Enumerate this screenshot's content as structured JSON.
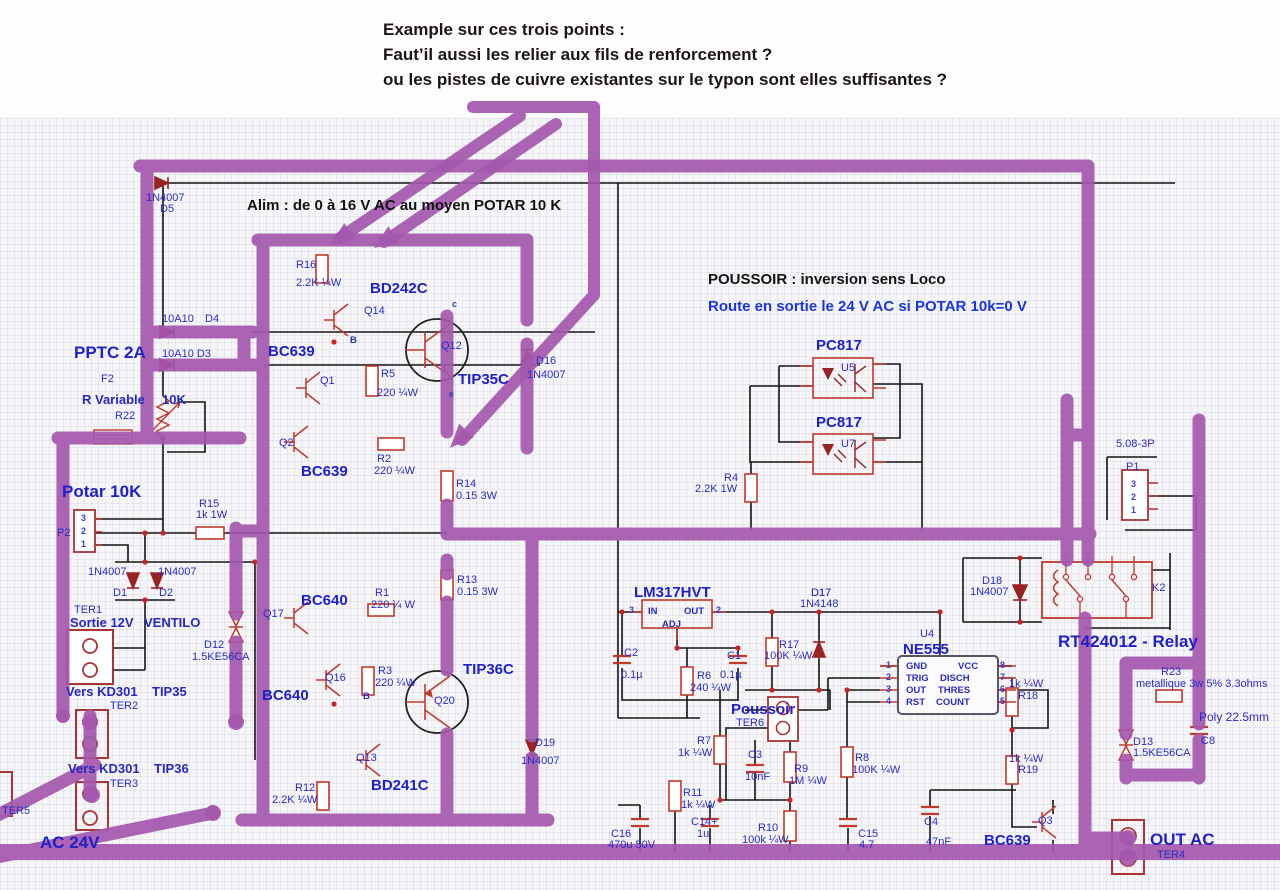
{
  "annotation": {
    "line1": "Example sur ces trois points :",
    "line2": "Faut’il aussi les relier aux fils de renforcement ?",
    "line3": "ou les pistes de cuivre existantes sur le typon sont elles suffisantes ?"
  },
  "colors": {
    "reinforcement_purple": "#a458ae",
    "label_blue": "#2a2ac8",
    "component_red": "#c0392b",
    "diode_dark_red": "#992222",
    "wire_black": "#141414",
    "heading_blue": "#1a35e0"
  },
  "headings": {
    "alim": "Alim : de 0 à 16 V AC au moyen POTAR 10 K",
    "poussoir": "POUSSOIR : inversion sens Loco",
    "route": "Route en sortie le 24 V AC si POTAR 10k=0 V"
  },
  "labels": [
    {
      "t": "Alim : de 0 à 16 V AC au moyen POTAR 10 K",
      "x": 247,
      "y": 198,
      "c": "blk"
    },
    {
      "t": "POUSSOIR : inversion sens Loco",
      "x": 708,
      "y": 272,
      "c": "blk"
    },
    {
      "t": "Route en sortie le 24 V AC si POTAR 10k=0 V",
      "x": 708,
      "y": 299,
      "c": "blu-b"
    },
    {
      "t": "1N4007",
      "x": 146,
      "y": 193,
      "c": "sm"
    },
    {
      "t": "D5",
      "x": 160,
      "y": 204,
      "c": "sm"
    },
    {
      "t": "10A10",
      "x": 162,
      "y": 314,
      "c": "sm"
    },
    {
      "t": "D4",
      "x": 205,
      "y": 314,
      "c": "sm"
    },
    {
      "t": "10A10 D3",
      "x": 162,
      "y": 349,
      "c": "sm"
    },
    {
      "t": "PPTC 2A",
      "x": 74,
      "y": 344,
      "c": "nb-lg"
    },
    {
      "t": "F2",
      "x": 101,
      "y": 374,
      "c": "sm"
    },
    {
      "t": "R Variable",
      "x": 82,
      "y": 393,
      "c": "smb14"
    },
    {
      "t": "10K",
      "x": 162,
      "y": 393,
      "c": "smb14"
    },
    {
      "t": "R22",
      "x": 115,
      "y": 411,
      "c": "sm"
    },
    {
      "t": "Potar 10K",
      "x": 62,
      "y": 483,
      "c": "nb-lg"
    },
    {
      "t": "P2",
      "x": 57,
      "y": 528,
      "c": "sm"
    },
    {
      "t": "3",
      "x": 81,
      "y": 514,
      "c": "tiny"
    },
    {
      "t": "2",
      "x": 81,
      "y": 527,
      "c": "tiny"
    },
    {
      "t": "1",
      "x": 81,
      "y": 540,
      "c": "tiny"
    },
    {
      "t": "R15",
      "x": 199,
      "y": 499,
      "c": "sm"
    },
    {
      "t": "1k 1W",
      "x": 196,
      "y": 510,
      "c": "sm"
    },
    {
      "t": "1N4007",
      "x": 88,
      "y": 567,
      "c": "sm"
    },
    {
      "t": "1N4007",
      "x": 158,
      "y": 567,
      "c": "sm"
    },
    {
      "t": "D1",
      "x": 113,
      "y": 588,
      "c": "sm"
    },
    {
      "t": "D2",
      "x": 159,
      "y": 588,
      "c": "sm"
    },
    {
      "t": "TER1",
      "x": 74,
      "y": 605,
      "c": "sm"
    },
    {
      "t": "Sortie 12V",
      "x": 70,
      "y": 616,
      "c": "smb14"
    },
    {
      "t": "VENTILO",
      "x": 144,
      "y": 616,
      "c": "smb14"
    },
    {
      "t": "D12",
      "x": 204,
      "y": 640,
      "c": "sm"
    },
    {
      "t": "1.5KE56CA",
      "x": 192,
      "y": 652,
      "c": "sm"
    },
    {
      "t": "Vers KD301",
      "x": 66,
      "y": 685,
      "c": "smb14"
    },
    {
      "t": "TIP35",
      "x": 152,
      "y": 685,
      "c": "smb14"
    },
    {
      "t": "TER2",
      "x": 110,
      "y": 701,
      "c": "sm"
    },
    {
      "t": "Vers KD301",
      "x": 68,
      "y": 762,
      "c": "smb14"
    },
    {
      "t": "TIP36",
      "x": 154,
      "y": 762,
      "c": "smb14"
    },
    {
      "t": "TER3",
      "x": 110,
      "y": 779,
      "c": "sm"
    },
    {
      "t": "TER5",
      "x": 2,
      "y": 806,
      "c": "sm"
    },
    {
      "t": "AC 24V",
      "x": 40,
      "y": 834,
      "c": "nb-lg"
    },
    {
      "t": "BC639",
      "x": 268,
      "y": 344,
      "c": "nb"
    },
    {
      "t": "R16",
      "x": 296,
      "y": 260,
      "c": "sm"
    },
    {
      "t": "2.2K ¼W",
      "x": 296,
      "y": 278,
      "c": "sm"
    },
    {
      "t": "BD242C",
      "x": 370,
      "y": 281,
      "c": "nb"
    },
    {
      "t": "Q14",
      "x": 364,
      "y": 306,
      "c": "sm"
    },
    {
      "t": "Q1",
      "x": 320,
      "y": 376,
      "c": "sm"
    },
    {
      "t": "R5",
      "x": 381,
      "y": 369,
      "c": "sm"
    },
    {
      "t": "220 ¼W",
      "x": 377,
      "y": 388,
      "c": "sm"
    },
    {
      "t": "Q12",
      "x": 441,
      "y": 341,
      "c": "sm"
    },
    {
      "t": "B",
      "x": 350,
      "y": 336,
      "c": "pin"
    },
    {
      "t": "c",
      "x": 452,
      "y": 300,
      "c": "tiny"
    },
    {
      "t": "e",
      "x": 449,
      "y": 390,
      "c": "tiny"
    },
    {
      "t": "TIP35C",
      "x": 458,
      "y": 372,
      "c": "nb"
    },
    {
      "t": "D16",
      "x": 536,
      "y": 356,
      "c": "sm"
    },
    {
      "t": "1N4007",
      "x": 527,
      "y": 370,
      "c": "sm"
    },
    {
      "t": "Q2",
      "x": 279,
      "y": 438,
      "c": "sm"
    },
    {
      "t": "BC639",
      "x": 301,
      "y": 464,
      "c": "nb"
    },
    {
      "t": "R2",
      "x": 377,
      "y": 454,
      "c": "sm"
    },
    {
      "t": "220 ¼W",
      "x": 374,
      "y": 466,
      "c": "sm"
    },
    {
      "t": "R14",
      "x": 456,
      "y": 479,
      "c": "sm"
    },
    {
      "t": "0.15 3W",
      "x": 456,
      "y": 491,
      "c": "sm"
    },
    {
      "t": "R13",
      "x": 457,
      "y": 575,
      "c": "sm"
    },
    {
      "t": "0.15 3W",
      "x": 457,
      "y": 587,
      "c": "sm"
    },
    {
      "t": "BC640",
      "x": 301,
      "y": 593,
      "c": "nb"
    },
    {
      "t": "R1",
      "x": 375,
      "y": 588,
      "c": "sm"
    },
    {
      "t": "220 ¼ W",
      "x": 371,
      "y": 600,
      "c": "sm"
    },
    {
      "t": "Q17",
      "x": 263,
      "y": 609,
      "c": "sm"
    },
    {
      "t": "BC640",
      "x": 262,
      "y": 688,
      "c": "nb"
    },
    {
      "t": "Q16",
      "x": 325,
      "y": 673,
      "c": "sm"
    },
    {
      "t": "R3",
      "x": 378,
      "y": 666,
      "c": "sm"
    },
    {
      "t": "220 ¼W",
      "x": 375,
      "y": 678,
      "c": "sm"
    },
    {
      "t": "B",
      "x": 363,
      "y": 692,
      "c": "pin"
    },
    {
      "t": "TIP36C",
      "x": 463,
      "y": 662,
      "c": "nb"
    },
    {
      "t": "Q20",
      "x": 434,
      "y": 696,
      "c": "sm"
    },
    {
      "t": "Q13",
      "x": 356,
      "y": 753,
      "c": "sm"
    },
    {
      "t": "BD241C",
      "x": 371,
      "y": 778,
      "c": "nb"
    },
    {
      "t": "R12",
      "x": 295,
      "y": 783,
      "c": "sm"
    },
    {
      "t": "2.2K ¼W",
      "x": 272,
      "y": 795,
      "c": "sm"
    },
    {
      "t": "D19",
      "x": 535,
      "y": 738,
      "c": "sm"
    },
    {
      "t": "1N4007",
      "x": 521,
      "y": 756,
      "c": "sm"
    },
    {
      "t": "PC817",
      "x": 816,
      "y": 338,
      "c": "nb"
    },
    {
      "t": "U5",
      "x": 841,
      "y": 363,
      "c": "sm"
    },
    {
      "t": "PC817",
      "x": 816,
      "y": 415,
      "c": "nb"
    },
    {
      "t": "U7",
      "x": 841,
      "y": 439,
      "c": "sm"
    },
    {
      "t": "R4",
      "x": 724,
      "y": 473,
      "c": "sm"
    },
    {
      "t": "2.2K 1W",
      "x": 695,
      "y": 484,
      "c": "sm"
    },
    {
      "t": "LM317HVT",
      "x": 634,
      "y": 585,
      "c": "nb"
    },
    {
      "t": "IN",
      "x": 648,
      "y": 607,
      "c": "pin"
    },
    {
      "t": "OUT",
      "x": 684,
      "y": 607,
      "c": "pin"
    },
    {
      "t": "ADJ",
      "x": 662,
      "y": 620,
      "c": "pin"
    },
    {
      "t": "3",
      "x": 629,
      "y": 606,
      "c": "tiny"
    },
    {
      "t": "2",
      "x": 716,
      "y": 606,
      "c": "tiny"
    },
    {
      "t": "C2",
      "x": 624,
      "y": 648,
      "c": "sm"
    },
    {
      "t": "0.1µ",
      "x": 621,
      "y": 670,
      "c": "sm"
    },
    {
      "t": "R6",
      "x": 697,
      "y": 671,
      "c": "sm"
    },
    {
      "t": "240 ¼W",
      "x": 690,
      "y": 683,
      "c": "sm"
    },
    {
      "t": "C1",
      "x": 727,
      "y": 651,
      "c": "sm"
    },
    {
      "t": "0.1µ",
      "x": 720,
      "y": 670,
      "c": "sm"
    },
    {
      "t": "D17",
      "x": 811,
      "y": 588,
      "c": "sm"
    },
    {
      "t": "1N4148",
      "x": 800,
      "y": 599,
      "c": "sm"
    },
    {
      "t": "R17",
      "x": 779,
      "y": 640,
      "c": "sm"
    },
    {
      "t": "100K ¼W",
      "x": 764,
      "y": 651,
      "c": "sm"
    },
    {
      "t": "U4",
      "x": 920,
      "y": 629,
      "c": "sm"
    },
    {
      "t": "NE555",
      "x": 903,
      "y": 642,
      "c": "nb"
    },
    {
      "t": "GND",
      "x": 906,
      "y": 662,
      "c": "pin"
    },
    {
      "t": "VCC",
      "x": 958,
      "y": 662,
      "c": "pin"
    },
    {
      "t": "TRIG",
      "x": 906,
      "y": 674,
      "c": "pin"
    },
    {
      "t": "DISCH",
      "x": 940,
      "y": 674,
      "c": "pin"
    },
    {
      "t": "OUT",
      "x": 906,
      "y": 686,
      "c": "pin"
    },
    {
      "t": "THRES",
      "x": 938,
      "y": 686,
      "c": "pin"
    },
    {
      "t": "RST",
      "x": 906,
      "y": 698,
      "c": "pin"
    },
    {
      "t": "COUNT",
      "x": 936,
      "y": 698,
      "c": "pin"
    },
    {
      "t": "1",
      "x": 886,
      "y": 661,
      "c": "tiny"
    },
    {
      "t": "2",
      "x": 886,
      "y": 673,
      "c": "tiny"
    },
    {
      "t": "3",
      "x": 886,
      "y": 685,
      "c": "tiny"
    },
    {
      "t": "4",
      "x": 886,
      "y": 697,
      "c": "tiny"
    },
    {
      "t": "8",
      "x": 1000,
      "y": 661,
      "c": "tiny"
    },
    {
      "t": "7",
      "x": 1000,
      "y": 673,
      "c": "tiny"
    },
    {
      "t": "6",
      "x": 1000,
      "y": 685,
      "c": "tiny"
    },
    {
      "t": "5",
      "x": 1000,
      "y": 697,
      "c": "tiny"
    },
    {
      "t": "Poussoir",
      "x": 731,
      "y": 702,
      "c": "nb"
    },
    {
      "t": "TER6",
      "x": 736,
      "y": 718,
      "c": "sm"
    },
    {
      "t": "R7",
      "x": 697,
      "y": 736,
      "c": "sm"
    },
    {
      "t": "1k ¼W",
      "x": 678,
      "y": 748,
      "c": "sm"
    },
    {
      "t": "C3",
      "x": 748,
      "y": 750,
      "c": "sm"
    },
    {
      "t": "10nF",
      "x": 745,
      "y": 772,
      "c": "sm"
    },
    {
      "t": "R9",
      "x": 794,
      "y": 764,
      "c": "sm"
    },
    {
      "t": "1M ¼W",
      "x": 789,
      "y": 776,
      "c": "sm"
    },
    {
      "t": "R8",
      "x": 855,
      "y": 753,
      "c": "sm"
    },
    {
      "t": "100K ¼W",
      "x": 852,
      "y": 765,
      "c": "sm"
    },
    {
      "t": "R11",
      "x": 683,
      "y": 788,
      "c": "sm"
    },
    {
      "t": "1k ¼W",
      "x": 681,
      "y": 800,
      "c": "sm"
    },
    {
      "t": "C14+",
      "x": 691,
      "y": 817,
      "c": "sm"
    },
    {
      "t": "1u",
      "x": 697,
      "y": 829,
      "c": "sm"
    },
    {
      "t": "R10",
      "x": 758,
      "y": 823,
      "c": "sm"
    },
    {
      "t": "100k ¼W",
      "x": 742,
      "y": 835,
      "c": "sm"
    },
    {
      "t": "C15",
      "x": 858,
      "y": 829,
      "c": "sm"
    },
    {
      "t": "4.7",
      "x": 859,
      "y": 840,
      "c": "sm"
    },
    {
      "t": "C4",
      "x": 924,
      "y": 817,
      "c": "sm"
    },
    {
      "t": "47nF",
      "x": 926,
      "y": 837,
      "c": "sm"
    },
    {
      "t": "C16",
      "x": 611,
      "y": 829,
      "c": "sm"
    },
    {
      "t": "470u 50V",
      "x": 608,
      "y": 840,
      "c": "sm"
    },
    {
      "t": "1k ¼W",
      "x": 1009,
      "y": 679,
      "c": "sm"
    },
    {
      "t": "R18",
      "x": 1018,
      "y": 691,
      "c": "sm"
    },
    {
      "t": "1k ¼W",
      "x": 1009,
      "y": 754,
      "c": "sm"
    },
    {
      "t": "R19",
      "x": 1018,
      "y": 765,
      "c": "sm"
    },
    {
      "t": "D17",
      "x": 811,
      "y": 588,
      "c": "sm"
    },
    {
      "t": "D18",
      "x": 982,
      "y": 576,
      "c": "sm"
    },
    {
      "t": "1N4007",
      "x": 970,
      "y": 587,
      "c": "sm"
    },
    {
      "t": "5.08-3P",
      "x": 1116,
      "y": 439,
      "c": "sm"
    },
    {
      "t": "P1",
      "x": 1126,
      "y": 462,
      "c": "sm"
    },
    {
      "t": "3",
      "x": 1131,
      "y": 480,
      "c": "tiny"
    },
    {
      "t": "2",
      "x": 1131,
      "y": 493,
      "c": "tiny"
    },
    {
      "t": "1",
      "x": 1131,
      "y": 506,
      "c": "tiny"
    },
    {
      "t": "K2",
      "x": 1152,
      "y": 583,
      "c": "sm"
    },
    {
      "t": "RT424012 - Relay",
      "x": 1058,
      "y": 633,
      "c": "nb-lg"
    },
    {
      "t": "R23",
      "x": 1161,
      "y": 667,
      "c": "sm"
    },
    {
      "t": "metallique 3w 5% 3.3ohms",
      "x": 1136,
      "y": 679,
      "c": "sm"
    },
    {
      "t": "Poly 22.5mm",
      "x": 1199,
      "y": 711,
      "c": "sm13"
    },
    {
      "t": "D13",
      "x": 1133,
      "y": 737,
      "c": "sm"
    },
    {
      "t": "1.5KE56CA",
      "x": 1133,
      "y": 748,
      "c": "sm"
    },
    {
      "t": "C8",
      "x": 1201,
      "y": 736,
      "c": "sm"
    },
    {
      "t": "BC639",
      "x": 984,
      "y": 833,
      "c": "nb"
    },
    {
      "t": "Q3",
      "x": 1038,
      "y": 816,
      "c": "sm"
    },
    {
      "t": "OUT AC",
      "x": 1150,
      "y": 831,
      "c": "nb-lg"
    },
    {
      "t": "TER4",
      "x": 1157,
      "y": 850,
      "c": "sm"
    }
  ]
}
